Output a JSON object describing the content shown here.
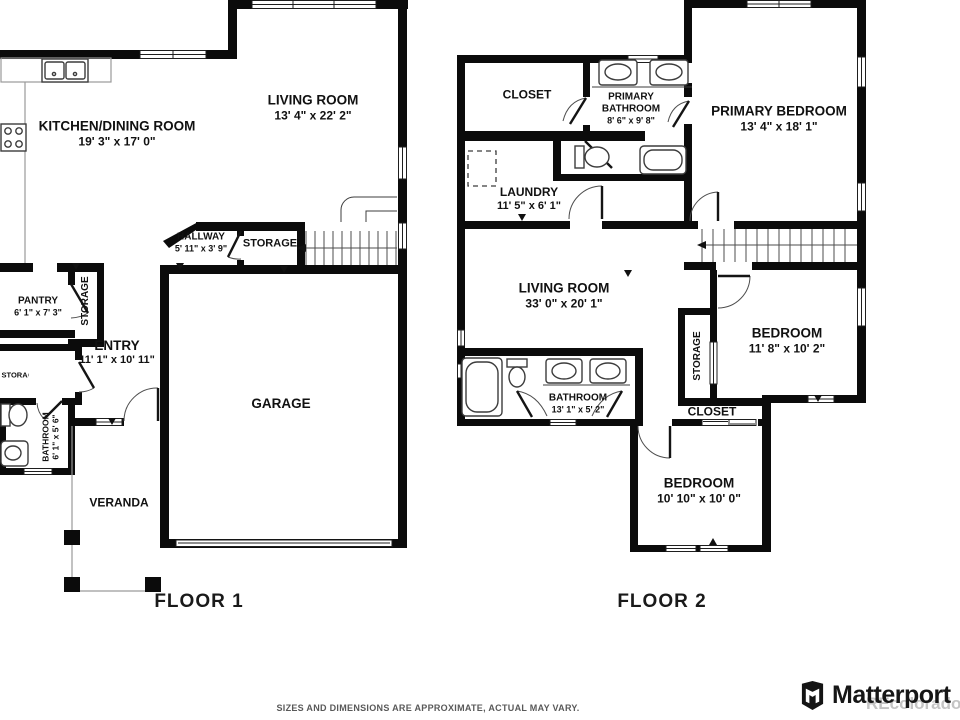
{
  "floor1": {
    "title": "FLOOR 1",
    "rooms": {
      "kitchen_dining": {
        "name": "KITCHEN/DINING ROOM",
        "dims": "19' 3\" x 17' 0\""
      },
      "living_room": {
        "name": "LIVING ROOM",
        "dims": "13' 4\" x 22' 2\""
      },
      "hallway": {
        "name": "HALLWAY",
        "dims": "5' 11\" x 3' 9\""
      },
      "storage_hall": {
        "name": "STORAGE"
      },
      "pantry": {
        "name": "PANTRY",
        "dims": "6' 1\" x 7' 3\""
      },
      "storage_pantry": {
        "name": "STORAGE"
      },
      "entry": {
        "name": "ENTRY",
        "dims": "11' 1\" x 10' 11\""
      },
      "storage_entry": {
        "name": "STORAGE"
      },
      "bathroom": {
        "name": "BATHROOM",
        "dims": "6' 1\" x 5' 6\""
      },
      "garage": {
        "name": "GARAGE"
      },
      "veranda": {
        "name": "VERANDA"
      }
    }
  },
  "floor2": {
    "title": "FLOOR 2",
    "rooms": {
      "closet_primary": {
        "name": "CLOSET"
      },
      "primary_bathroom": {
        "name": "PRIMARY BATHROOM",
        "dims": "8' 6\" x 9' 8\""
      },
      "primary_bedroom": {
        "name": "PRIMARY BEDROOM",
        "dims": "13' 4\" x 18' 1\""
      },
      "laundry": {
        "name": "LAUNDRY",
        "dims": "11' 5\" x 6' 1\""
      },
      "living_room": {
        "name": "LIVING ROOM",
        "dims": "33' 0\" x 20' 1\""
      },
      "bedroom_ne": {
        "name": "BEDROOM",
        "dims": "11' 8\" x 10' 2\""
      },
      "storage": {
        "name": "STORAGE"
      },
      "closet": {
        "name": "CLOSET"
      },
      "bathroom": {
        "name": "BATHROOM",
        "dims": "13' 1\" x 5' 2\""
      },
      "bedroom_s": {
        "name": "BEDROOM",
        "dims": "10' 10\" x 10' 0\""
      }
    }
  },
  "footer": {
    "disclaimer": "SIZES AND DIMENSIONS ARE APPROXIMATE, ACTUAL MAY VARY.",
    "brand": "Matterport",
    "watermark": "REcolorado"
  },
  "colors": {
    "wall": "#0b0b0b",
    "fixture_line": "#3c3c3c",
    "counter_line": "#9a9a9a",
    "label_text": "#111111",
    "disclaimer_text": "#595959",
    "watermark": "#c4c4c4",
    "brand_text": "#161616"
  }
}
